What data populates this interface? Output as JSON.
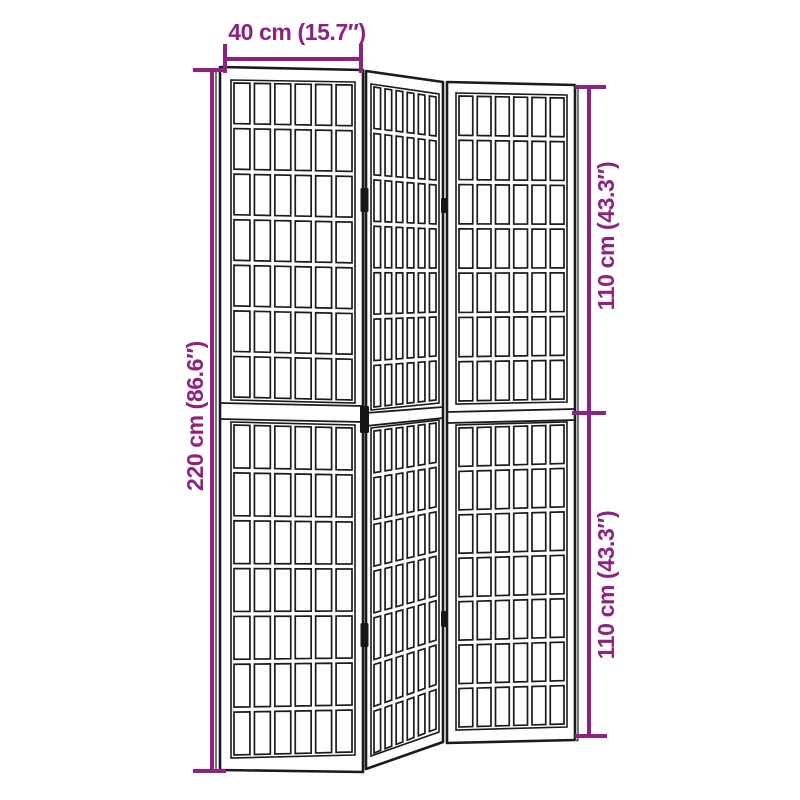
{
  "diagram": {
    "background": "#FFFFFF",
    "dimension_color": "#8E2181",
    "outline_color": "#1B1B1B",
    "labels": {
      "top_width": "40 cm (15.7″)",
      "left_total_height": "220 cm (86.6″)",
      "right_upper_height": "110 cm (43.3″)",
      "right_lower_height": "110 cm (43.3″)"
    },
    "object": {
      "panel_count": 3,
      "sections_per_panel": 2,
      "grid_columns": 6,
      "grid_rows_per_section": 7,
      "visible_hinges": 5
    }
  }
}
